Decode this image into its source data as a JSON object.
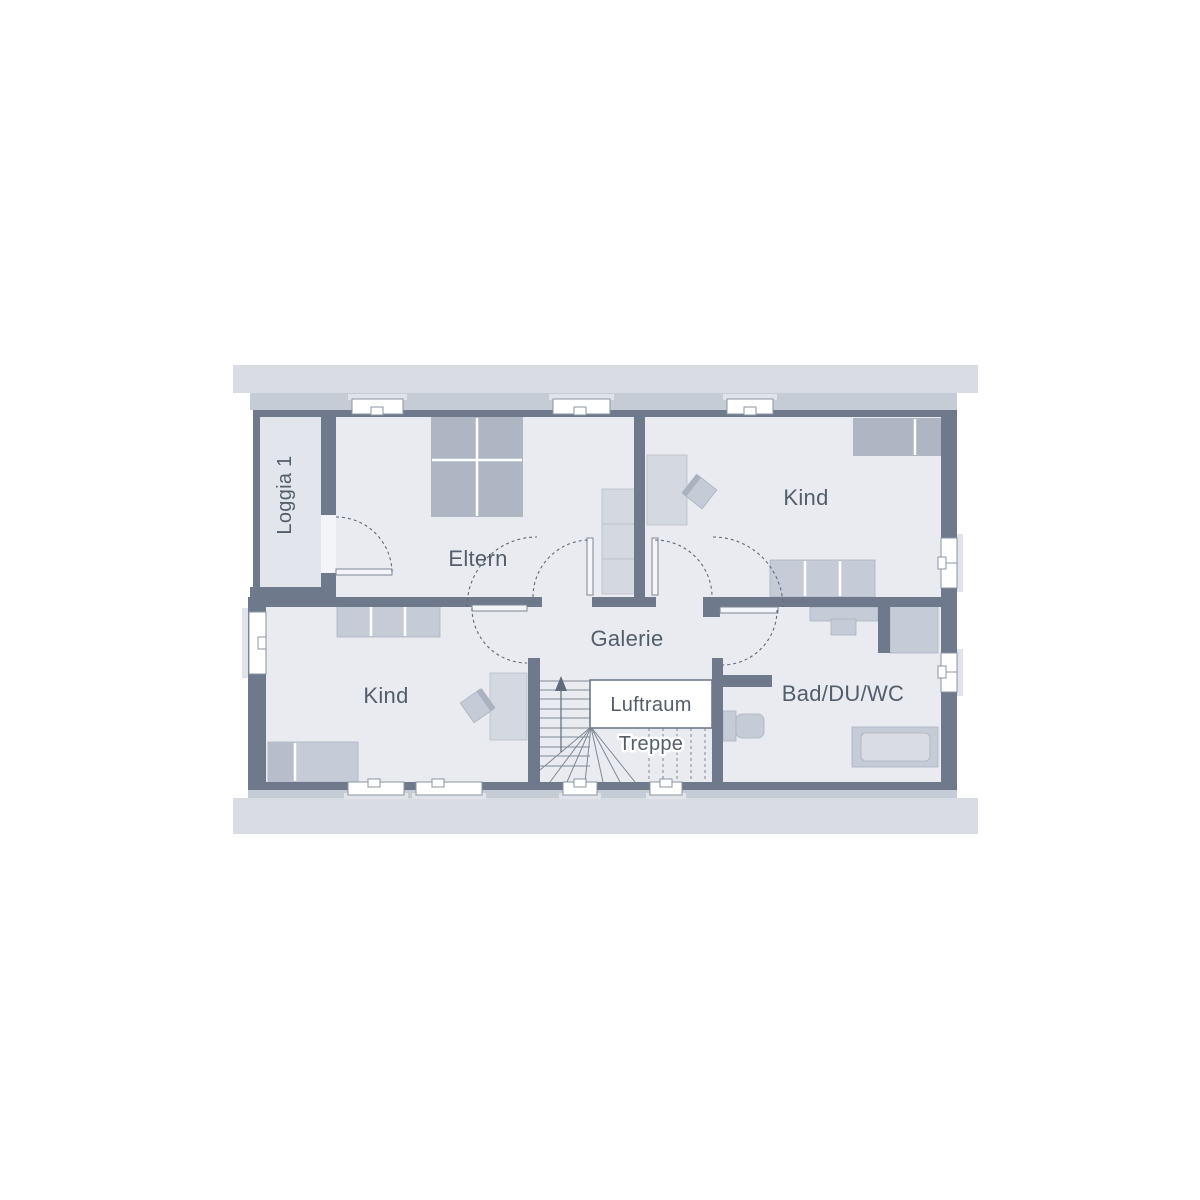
{
  "title": "Floor plan – upper floor",
  "palette": {
    "wall": "#6e7a8b",
    "roof_outer": "#d9dce3",
    "roof_inner": "#c6ccd5",
    "room": "#e9ebf0",
    "loggia": "#e2e6ec",
    "furn_dark": "#aeb5c3",
    "furn_mid": "#c6ccd7",
    "furn_light": "#d4d8e0",
    "window": "#ffffff",
    "text": "#545d6b"
  },
  "rooms": {
    "loggia": {
      "label": "Loggia 1"
    },
    "eltern": {
      "label": "Eltern"
    },
    "kind_top": {
      "label": "Kind"
    },
    "kind_bottom": {
      "label": "Kind"
    },
    "galerie": {
      "label": "Galerie"
    },
    "luftraum": {
      "label": "Luftraum"
    },
    "treppe": {
      "label": "Treppe"
    },
    "bad": {
      "label": "Bad/DU/WC"
    }
  }
}
